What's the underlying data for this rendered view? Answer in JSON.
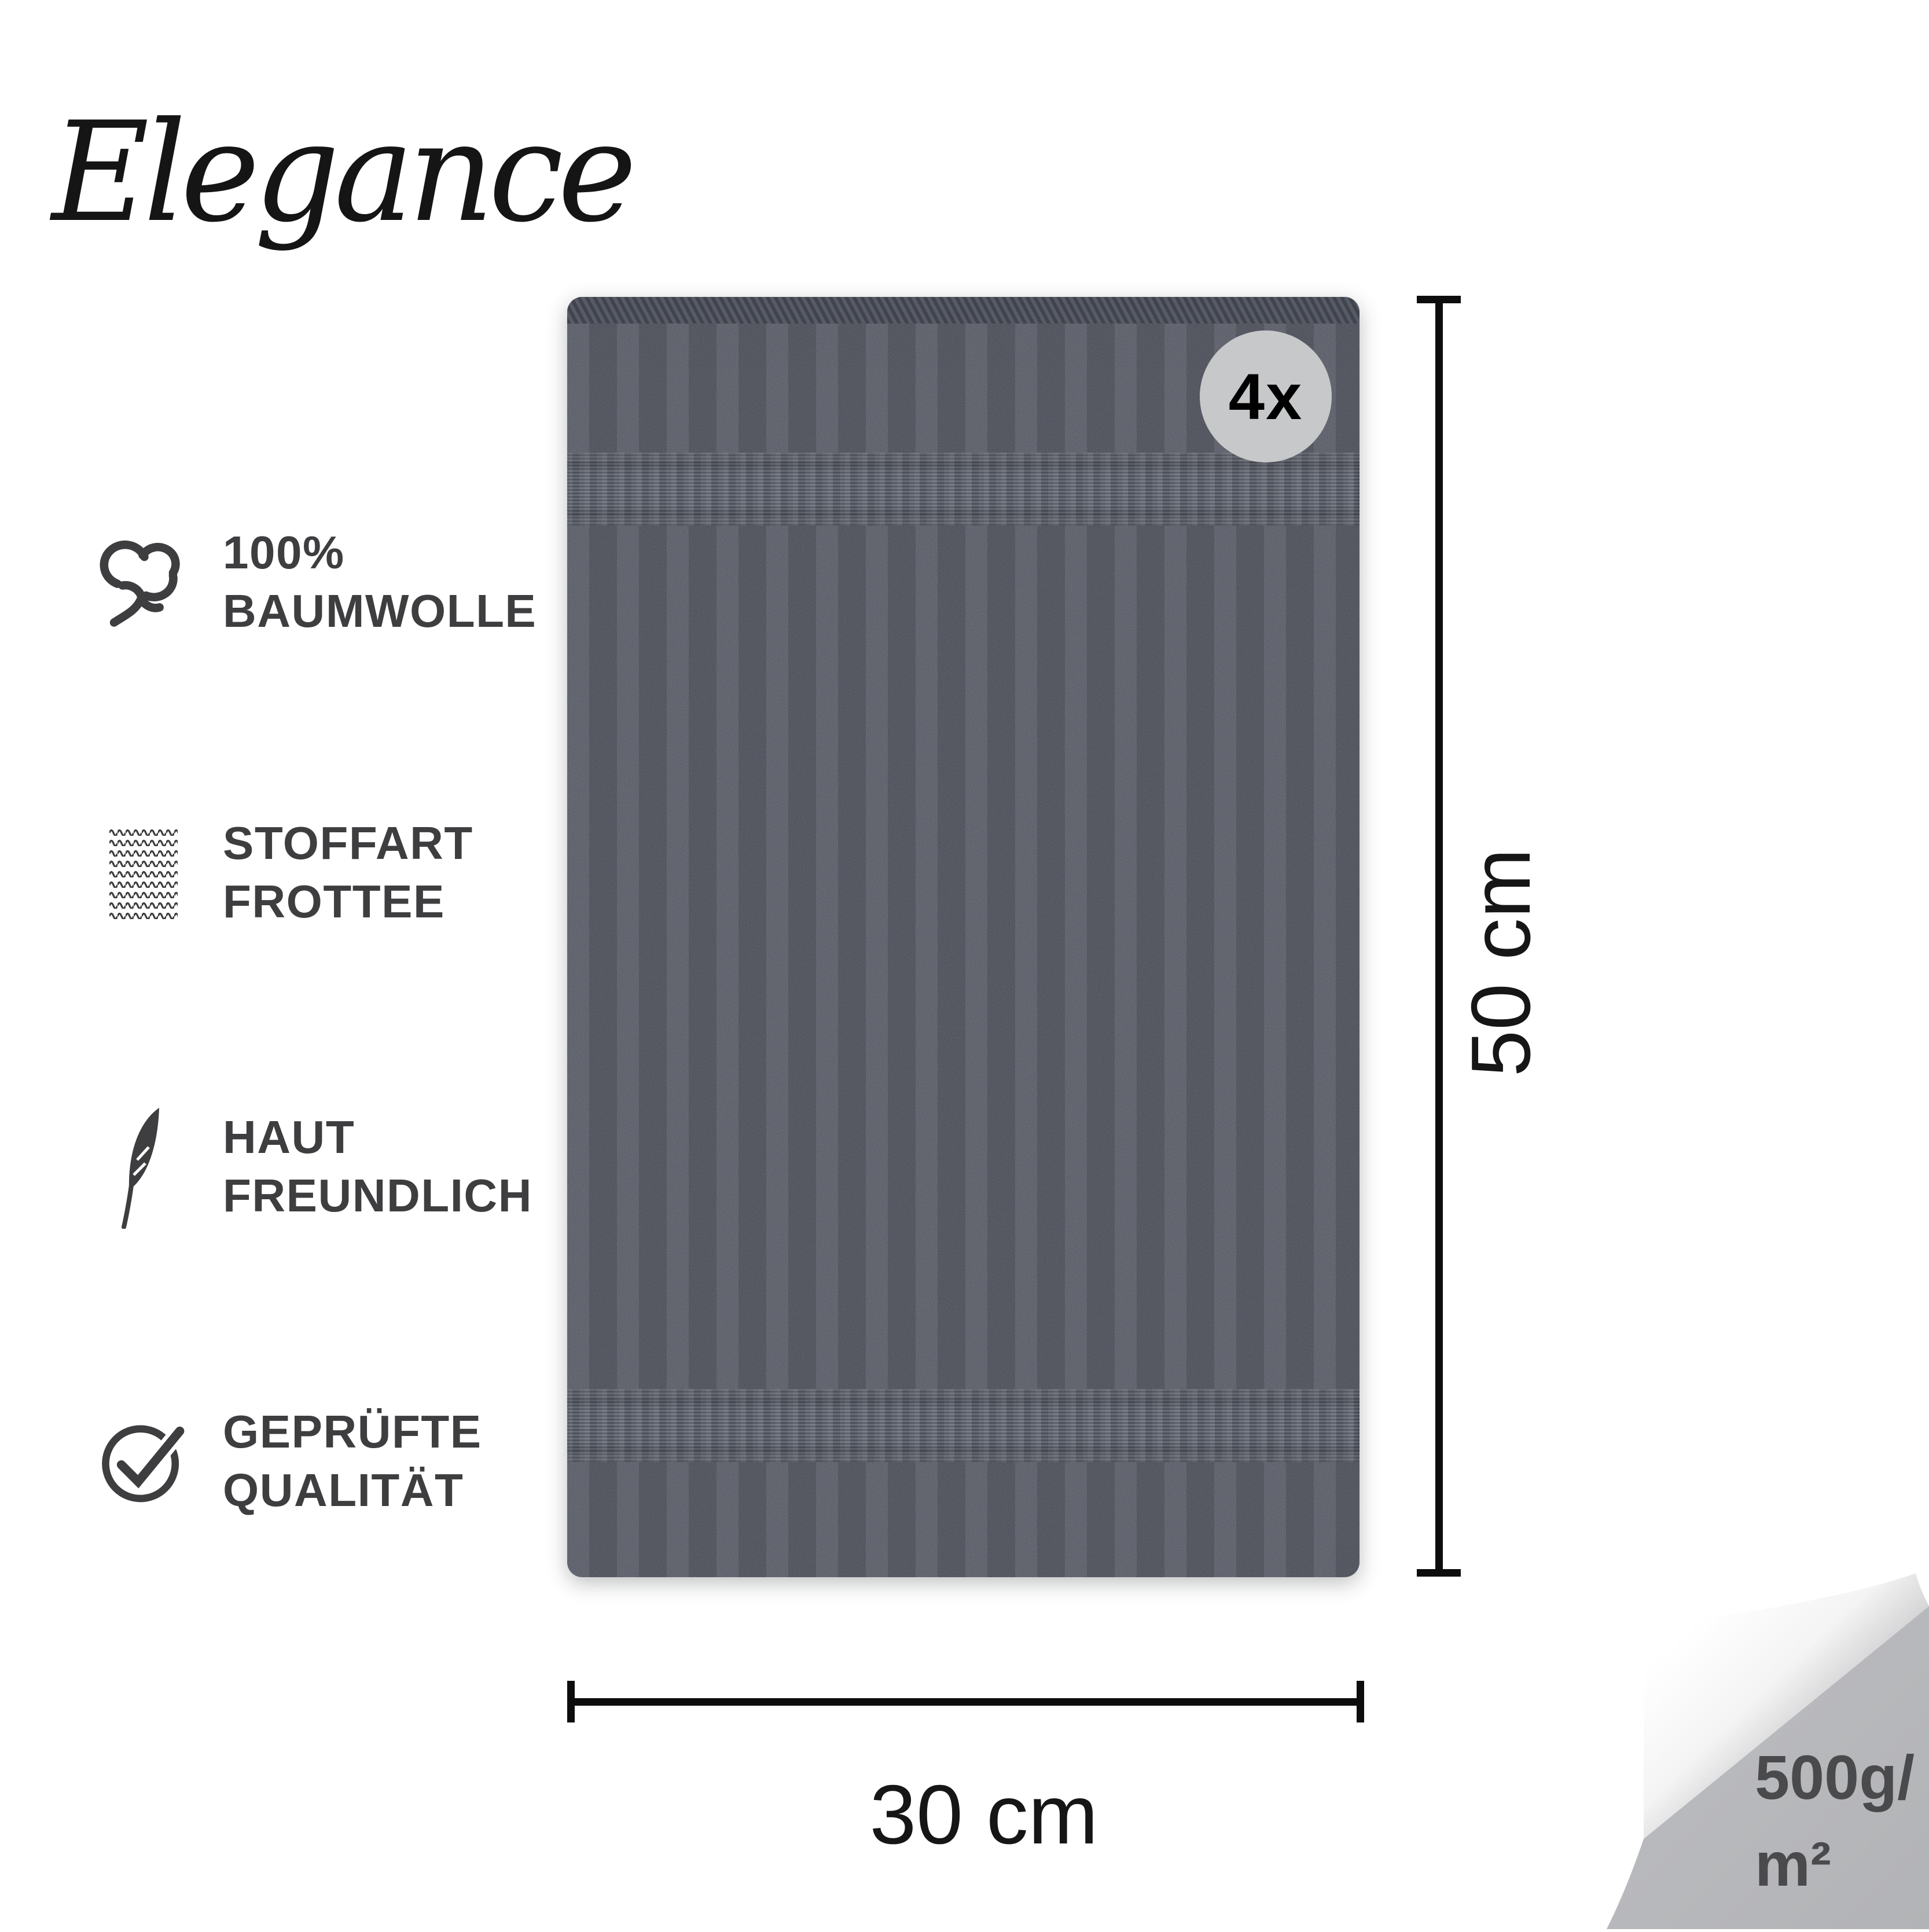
{
  "brand": {
    "logo_text": "Elegance"
  },
  "features": [
    {
      "icon": "cotton-icon",
      "line1": "100%",
      "line2": "BAUMWOLLE"
    },
    {
      "icon": "knit-fabric-icon",
      "line1": "STOFFART",
      "line2": "FROTTEE"
    },
    {
      "icon": "feather-icon",
      "line1": "HAUT",
      "line2": "FREUNDLICH"
    },
    {
      "icon": "check-circle-icon",
      "line1": "GEPRÜFTE",
      "line2": "QUALITÄT"
    }
  ],
  "towel": {
    "badge_count": "4x"
  },
  "dimensions": {
    "height_label": "50 cm",
    "width_label": "30 cm"
  },
  "weight_badge": {
    "line1": "500g/",
    "line2": "m²"
  },
  "colors": {
    "background": "#ffffff",
    "towel_base": "#4f525c",
    "towel_band": "#5d616c",
    "badge_bg": "#c6c8ca",
    "badge_text": "#000000",
    "feature_text": "#3e3e40",
    "dimension_line": "#0d0d0d",
    "corner_bg": "#b9babd",
    "corner_text": "#4a4a4c"
  }
}
